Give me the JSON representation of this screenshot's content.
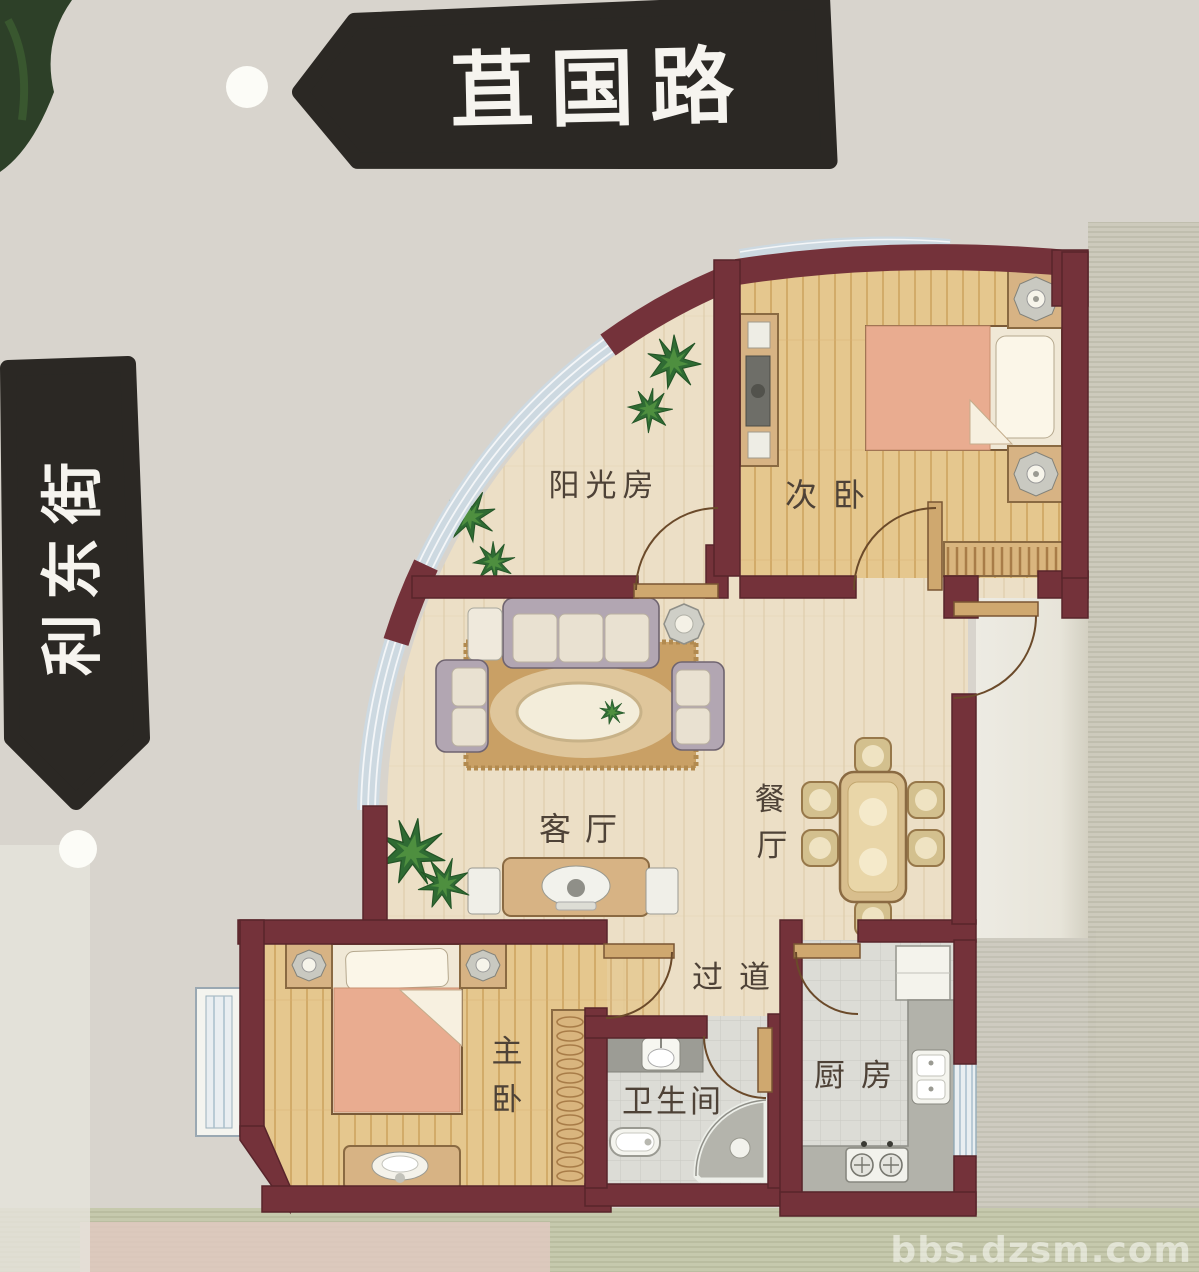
{
  "street_signs": {
    "top": "苴国路",
    "left": "利东街"
  },
  "rooms": {
    "sunroom": "阳光房",
    "secondary_bedroom": "次卧",
    "living_room": "客厅",
    "dining_room": "餐厅",
    "dining_char1": "餐",
    "dining_char2": "厅",
    "corridor": "过道",
    "master_bedroom": "主卧",
    "master_char1": "主",
    "master_char2": "卧",
    "bathroom": "卫生间",
    "kitchen": "厨房"
  },
  "watermark": "bbs.dzsm.com",
  "colors": {
    "wall": "#74323a",
    "glass_band": "#cdd9e1",
    "floor_cream": "#ecdfc6",
    "floor_gold": "#e5c78e",
    "floor_tile": "#dcdcd6",
    "sign_black": "#2b2824",
    "bed_pink": "#e9ac90",
    "plant_green": "#2f6b33"
  }
}
